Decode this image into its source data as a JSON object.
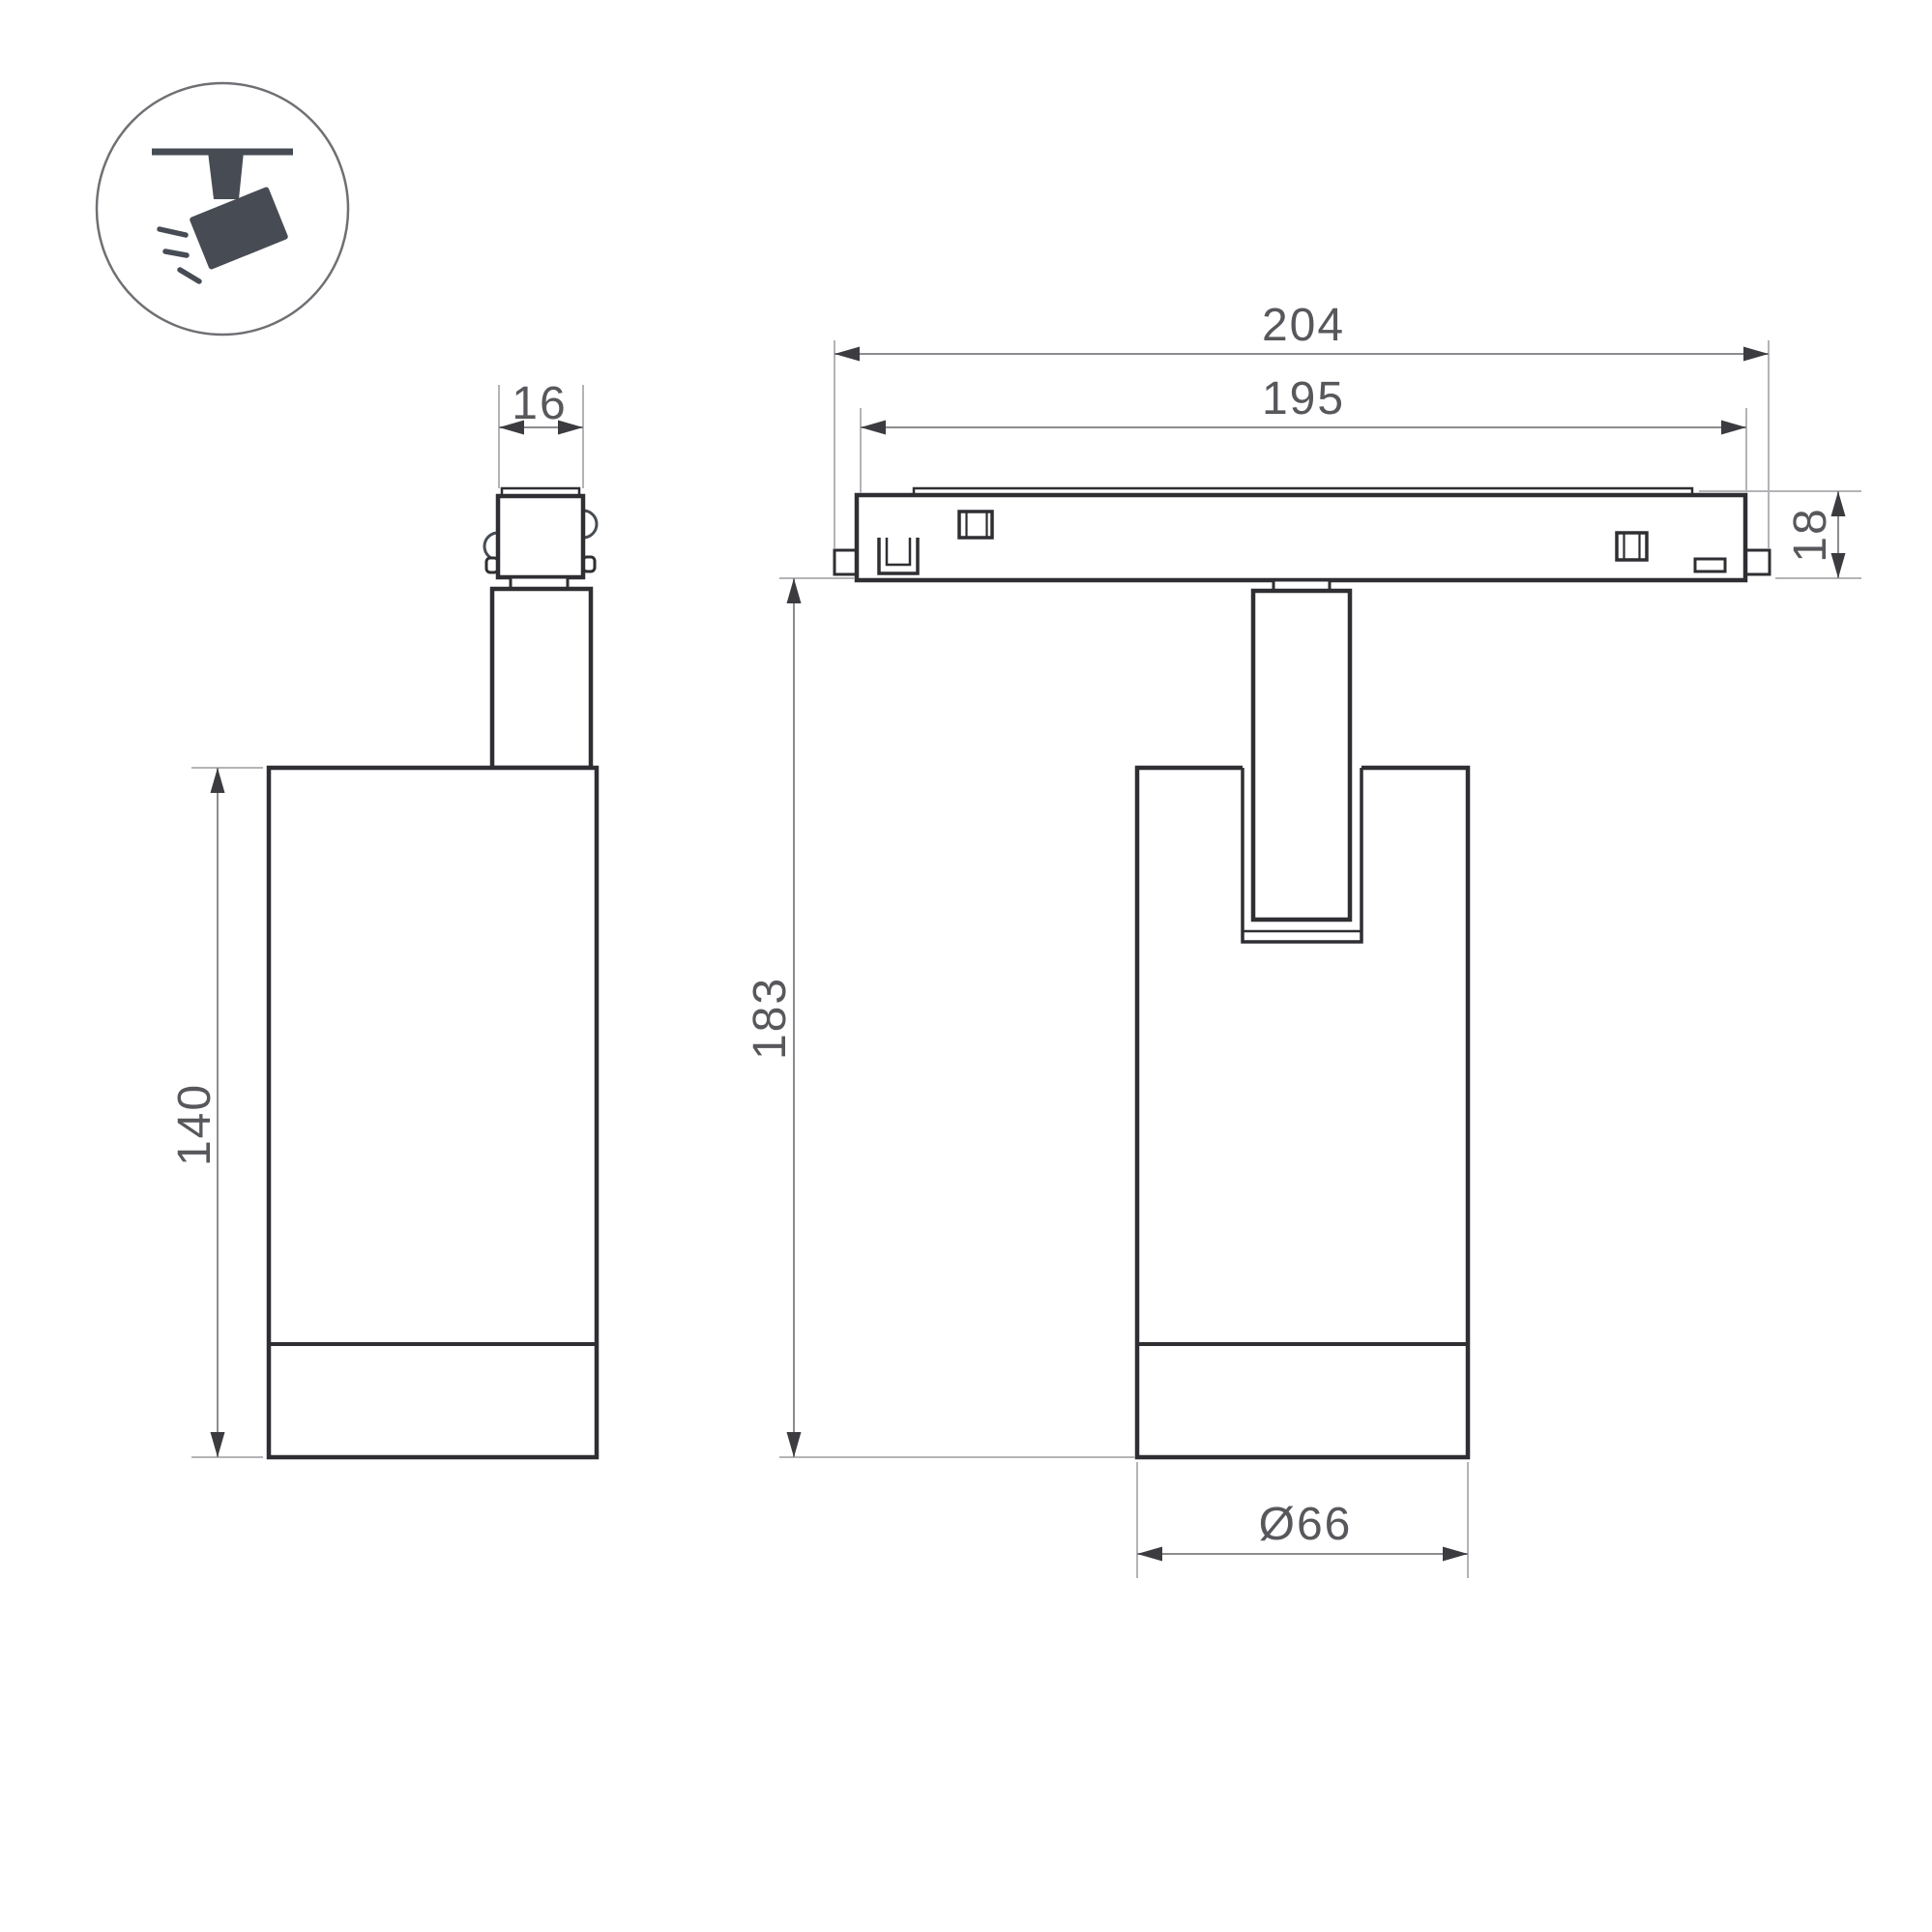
{
  "drawing": {
    "colors": {
      "outline": "#2f2f33",
      "detail": "#3a3a3e",
      "dim_line": "#8c8c90",
      "ext_line": "#b4b4b8",
      "arrow": "#3c3c40",
      "text": "#58585c",
      "icon_glyph": "#474c54",
      "icon_ring": "#6f6f74",
      "background": "#ffffff"
    },
    "icon": {
      "name": "ceiling-track-spotlight"
    },
    "views": {
      "side_view": {
        "dims": {
          "adapter_width": "16",
          "body_height": "140"
        }
      },
      "front_view": {
        "dims": {
          "track_length_outer": "204",
          "track_length_inner": "195",
          "track_height": "18",
          "overall_height": "183",
          "body_diameter": "Ø66"
        }
      }
    }
  }
}
